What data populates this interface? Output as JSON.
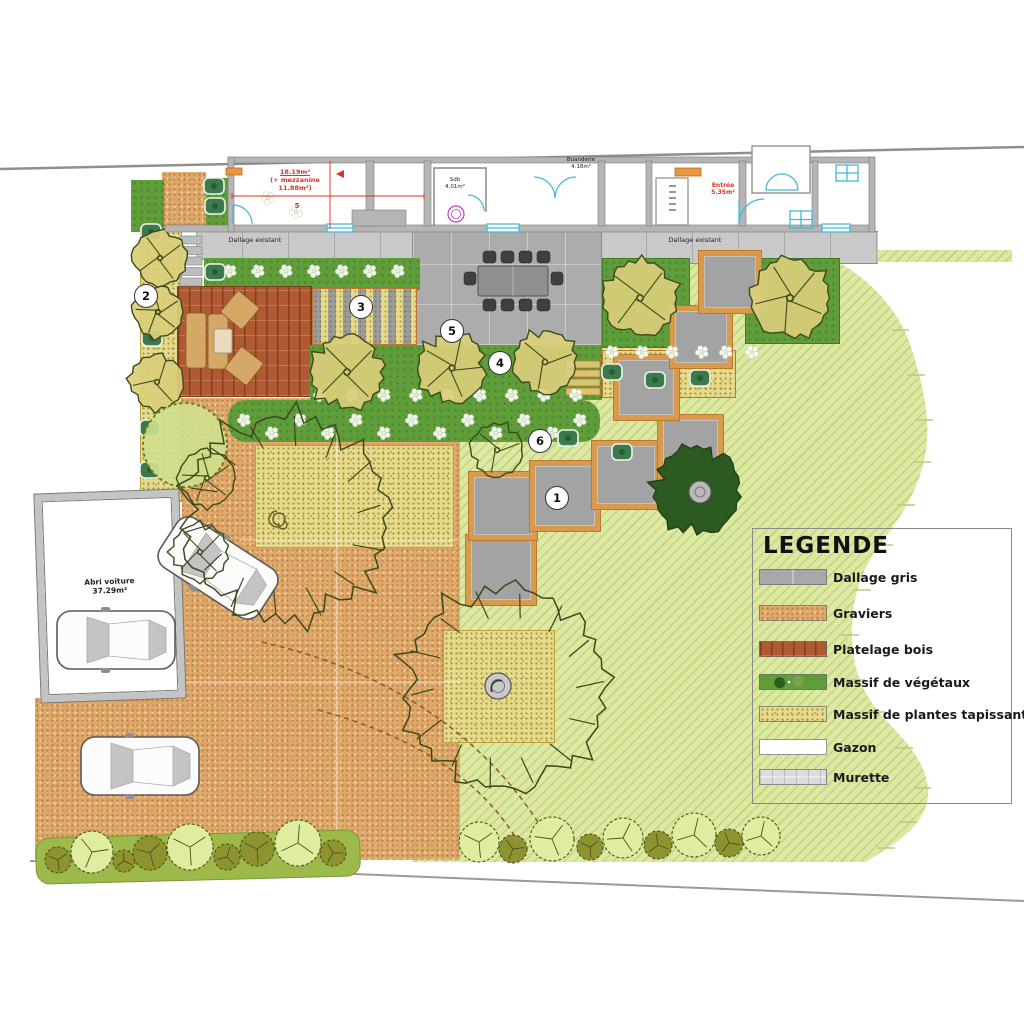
{
  "legend": {
    "title": "LEGENDE",
    "items": [
      {
        "key": "dallage",
        "label": "Dallage gris"
      },
      {
        "key": "graviers",
        "label": "Graviers"
      },
      {
        "key": "platelage",
        "label": "Platelage bois"
      },
      {
        "key": "vegetaux",
        "label": "Massif de végétaux"
      },
      {
        "key": "tapissantes",
        "label": "Massif de plantes tapissantes"
      },
      {
        "key": "gazon",
        "label": "Gazon"
      },
      {
        "key": "murette",
        "label": "Murette"
      }
    ]
  },
  "house": {
    "room_main": {
      "area": "18.19m²",
      "mezz1": "(+ mezzanine",
      "mezz2": "11.88m²)",
      "number": "5"
    },
    "sdb": {
      "name": "Sdb",
      "area": "4.01m²"
    },
    "buanderie": {
      "name": "Buanderie",
      "area": "4.18m²"
    },
    "entree": {
      "name": "Entrée",
      "area": "5.35m²"
    }
  },
  "site": {
    "dallage_left": "Dallage existant",
    "dallage_right": "Dallage existant",
    "carport1": "Abri voiture",
    "carport2": "37.29m²"
  },
  "markers": {
    "m1": "1",
    "m2": "2",
    "m3": "3",
    "m4": "4",
    "m5": "5",
    "m6": "6"
  },
  "colors": {
    "lawn": "#dde8a2",
    "gravel": "#e0a868",
    "deck": "#b05a33",
    "paving": "#a8a8a8",
    "massif": "#5f9c3a",
    "tapissantes": "#e7db8a",
    "red_label": "#e03020",
    "cyan": "#45b8d8"
  }
}
